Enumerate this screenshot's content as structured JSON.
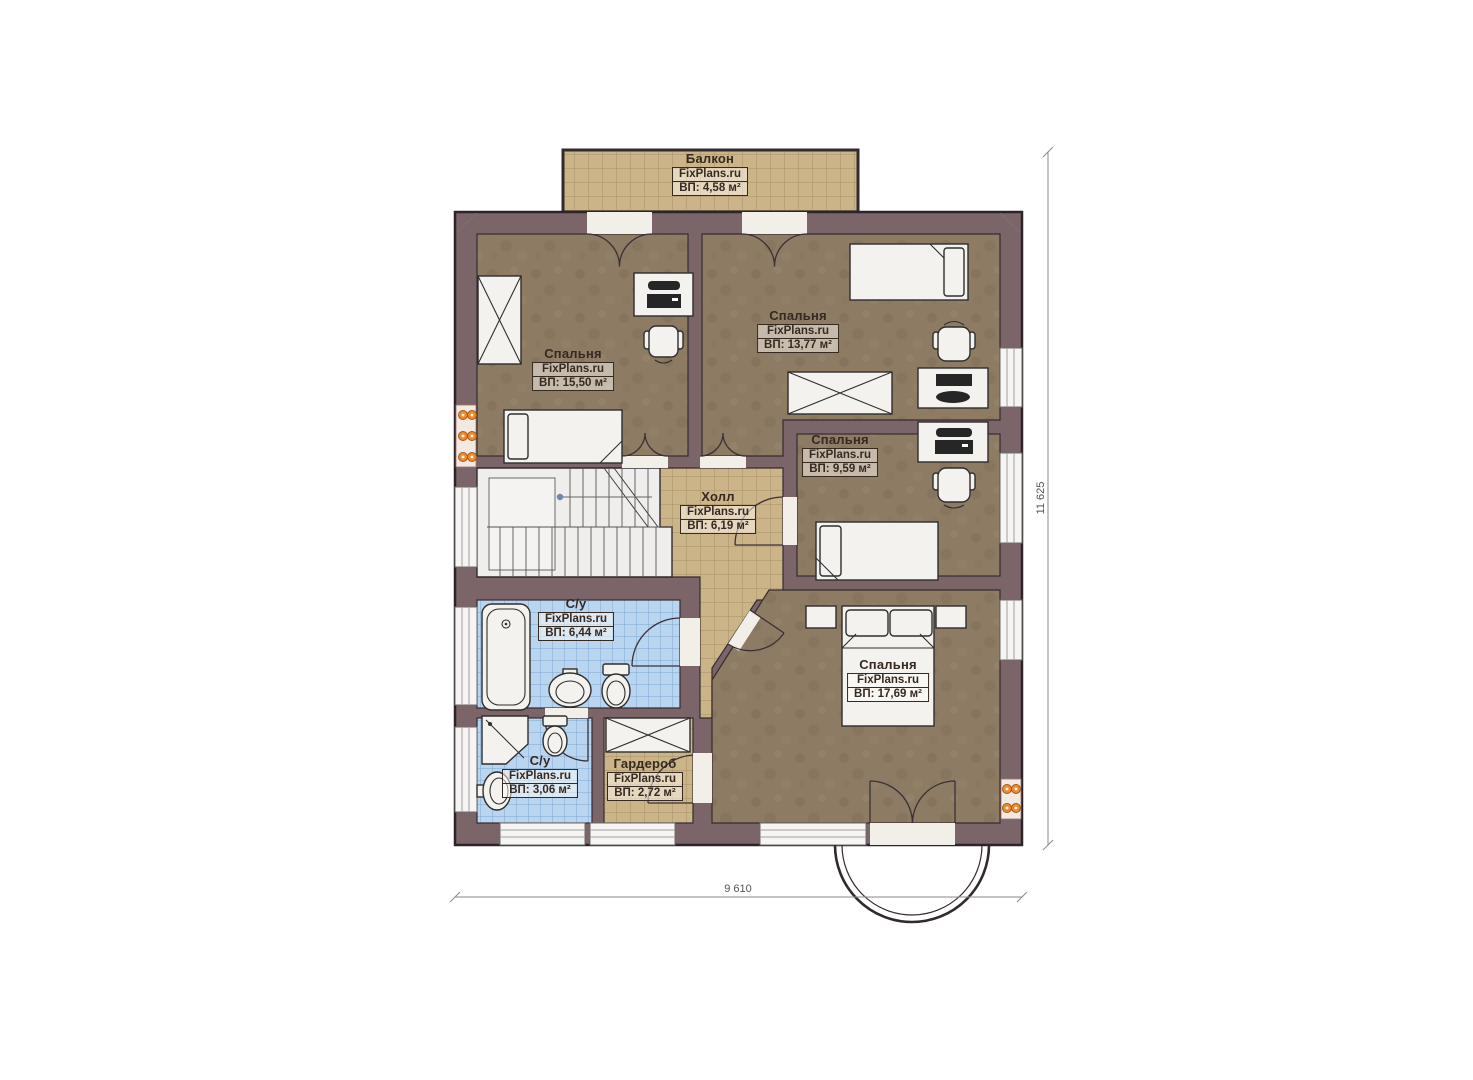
{
  "plan": {
    "type": "floor-plan",
    "brand": "FixPlans.ru",
    "rooms": [
      {
        "id": "balcony",
        "name": "Балкон",
        "brand": "FixPlans.ru",
        "area": "ВП: 4,58 м²"
      },
      {
        "id": "bedroom-1",
        "name": "Спальня",
        "brand": "FixPlans.ru",
        "area": "ВП: 15,50 м²"
      },
      {
        "id": "bedroom-2",
        "name": "Спальня",
        "brand": "FixPlans.ru",
        "area": "ВП: 13,77 м²"
      },
      {
        "id": "bedroom-3",
        "name": "Спальня",
        "brand": "FixPlans.ru",
        "area": "ВП: 9,59 м²"
      },
      {
        "id": "hall",
        "name": "Холл",
        "brand": "FixPlans.ru",
        "area": "ВП: 6,19 м²"
      },
      {
        "id": "bathroom-1",
        "name": "С/у",
        "brand": "FixPlans.ru",
        "area": "ВП: 6,44 м²"
      },
      {
        "id": "bathroom-2",
        "name": "С/у",
        "brand": "FixPlans.ru",
        "area": "ВП: 3,06 м²"
      },
      {
        "id": "wardrobe",
        "name": "Гардероб",
        "brand": "FixPlans.ru",
        "area": "ВП: 2,72 м²"
      },
      {
        "id": "bedroom-4",
        "name": "Спальня",
        "brand": "FixPlans.ru",
        "area": "ВП: 17,69 м²"
      }
    ],
    "dimensions": {
      "width_label": "9 610",
      "height_label": "11 625"
    },
    "colors": {
      "wall": "#7b6568",
      "bedroom_floor": "#8d7b63",
      "tile_tan": "#cbb588",
      "tile_blue": "#b9d5f0",
      "outlet_orange": "#ee8a2e"
    }
  }
}
